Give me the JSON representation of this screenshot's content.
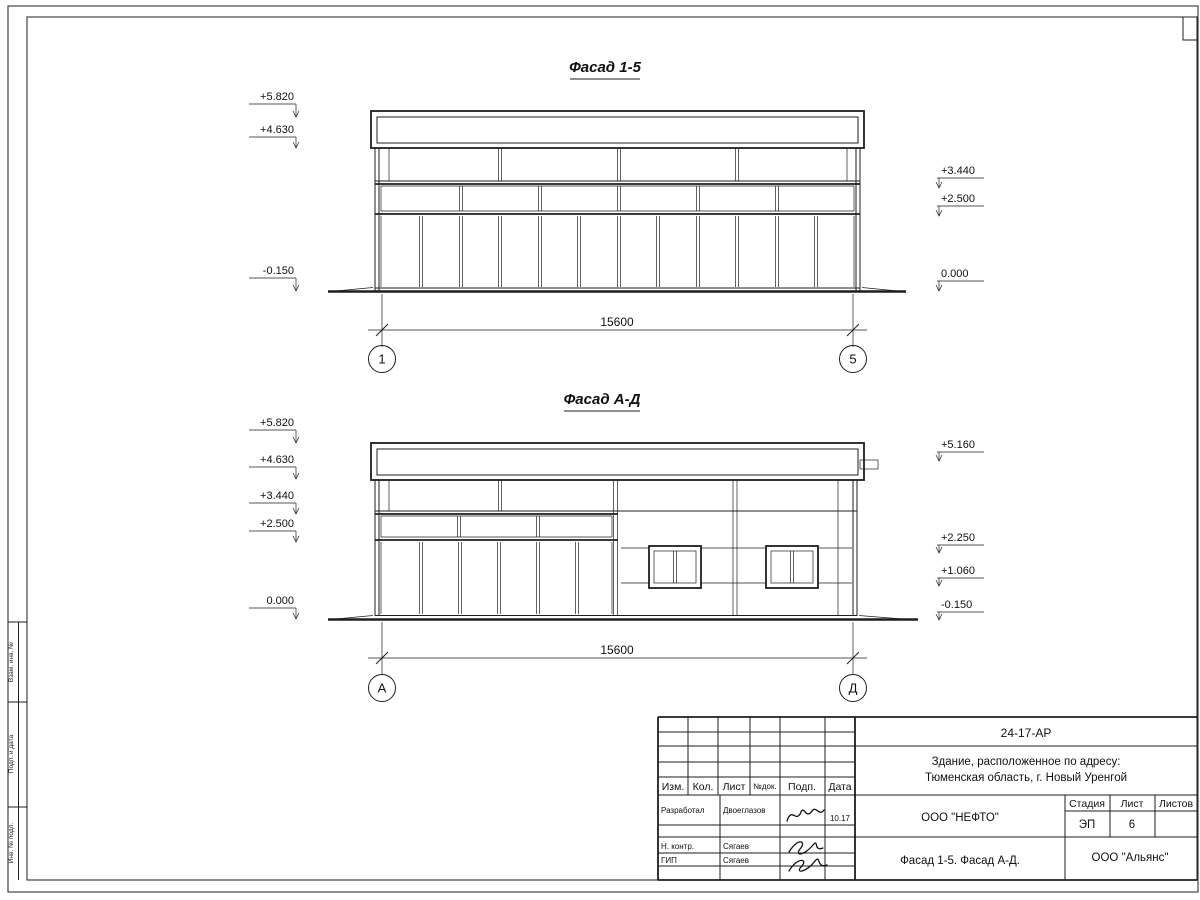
{
  "sheet": {
    "left_margin_labels": [
      "Взам. инв. №",
      "Подп. и дата",
      "Инв. № подл."
    ]
  },
  "facades": {
    "top": {
      "title": "Фасад 1-5",
      "marks_left": [
        "+5.820",
        "+4.630",
        "-0.150"
      ],
      "marks_right": [
        "+3.440",
        "+2.500",
        "0.000"
      ],
      "dim": "15600",
      "axis_left": "1",
      "axis_right": "5"
    },
    "bottom": {
      "title": "Фасад А-Д",
      "marks_left": [
        "+5.820",
        "+4.630",
        "+3.440",
        "+2.500",
        "0.000"
      ],
      "marks_right": [
        "+5.160",
        "+2.250",
        "+1.060",
        "-0.150"
      ],
      "dim": "15600",
      "axis_left": "А",
      "axis_right": "Д"
    }
  },
  "title_block": {
    "doc_code": "24-17-АР",
    "object_line1": "Здание, расположенное по адресу:",
    "object_line2": "Тюменская область, г. Новый Уренгой",
    "header_cols": [
      "Изм.",
      "Кол.",
      "Лист",
      "№док.",
      "Подп.",
      "Дата"
    ],
    "rows": [
      {
        "role": "Разработал",
        "name": "Двоеглазов",
        "date": "10.17"
      },
      {
        "role": "Н. контр.",
        "name": "Сягаев",
        "date": ""
      },
      {
        "role": "ГИП",
        "name": "Сягаев",
        "date": ""
      }
    ],
    "org": "ООО \"НЕФТО\"",
    "stage_label": "Стадия",
    "sheet_label": "Лист",
    "sheets_label": "Листов",
    "stage": "ЭП",
    "sheet_no": "6",
    "sheet_title": "Фасад 1-5. Фасад А-Д.",
    "company": "ООО \"Альянс\""
  }
}
